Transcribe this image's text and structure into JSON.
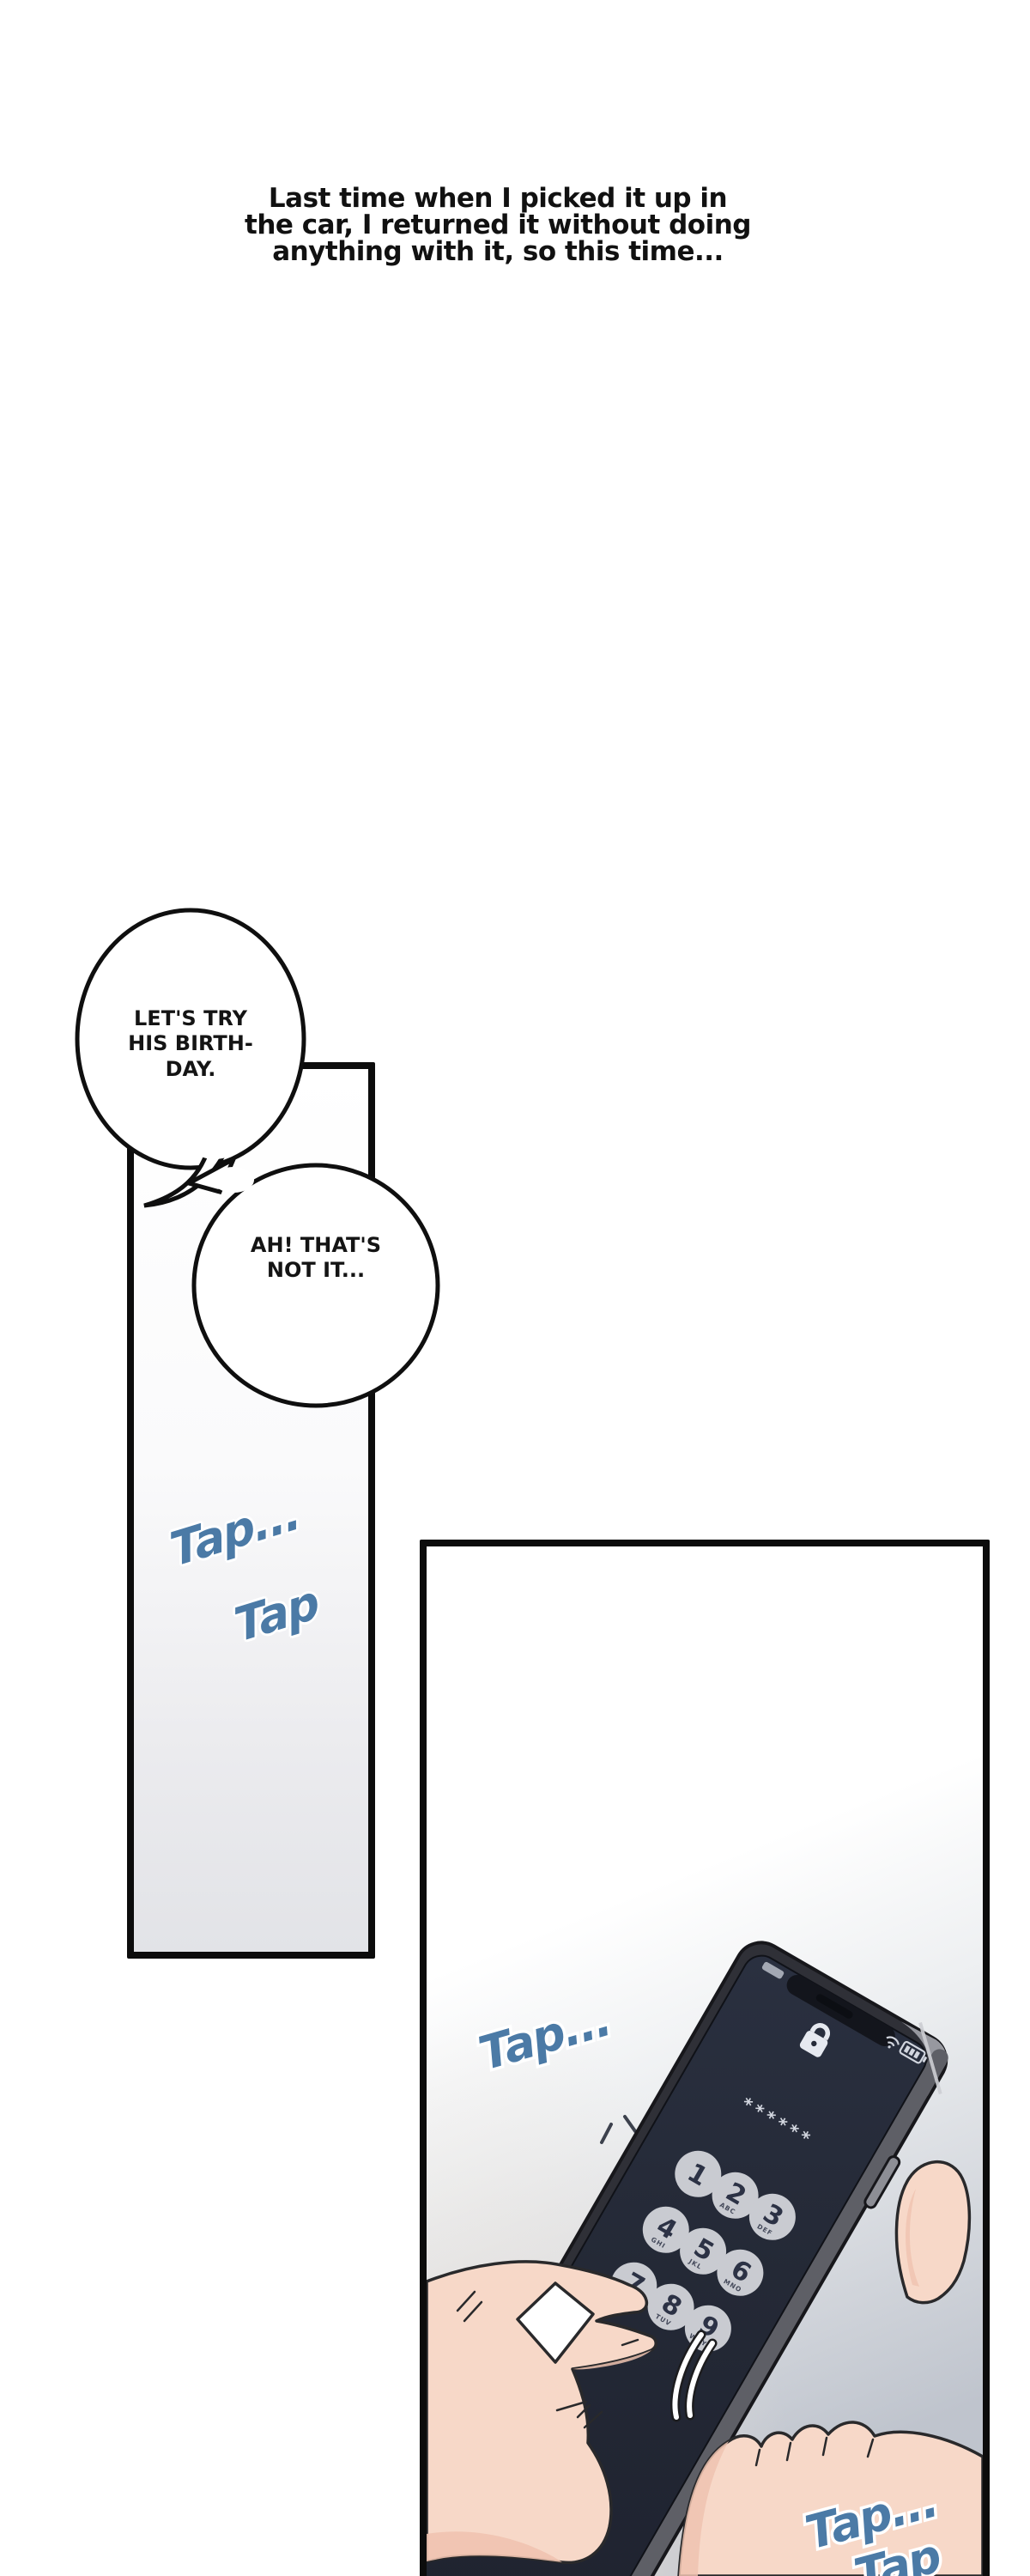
{
  "narration": {
    "lines": [
      "Last time when I picked it up in",
      "the car, I returned it without doing",
      "anything with it, so this time..."
    ]
  },
  "bubbles": {
    "bubble1": {
      "lines": [
        "LET'S TRY",
        "HIS BIRTH-",
        "DAY."
      ]
    },
    "bubble2": {
      "lines": [
        "AH! THAT'S",
        "NOT IT..."
      ]
    }
  },
  "sfx": {
    "color": "#4b7aa6",
    "panel1_tap_a": "Tap...",
    "panel1_tap_b": "Tap",
    "panel2_tap_top": "Tap...",
    "panel2_tap_bottom": "Tap...",
    "panel2_tap_partial": "Tap"
  },
  "phone": {
    "passcode_display": "******",
    "lock_icon": "lock-icon",
    "status_icons": [
      "wifi-icon",
      "battery-icon"
    ],
    "keypad": [
      {
        "digit": "1",
        "letters": ""
      },
      {
        "digit": "2",
        "letters": "ABC"
      },
      {
        "digit": "3",
        "letters": "DEF"
      },
      {
        "digit": "4",
        "letters": "GHI"
      },
      {
        "digit": "5",
        "letters": "JKL"
      },
      {
        "digit": "6",
        "letters": "MNO"
      },
      {
        "digit": "7",
        "letters": "PQRS"
      },
      {
        "digit": "8",
        "letters": "TUV"
      },
      {
        "digit": "9",
        "letters": "WXYZ"
      }
    ]
  },
  "colors": {
    "sfx_blue": "#4b7aa6",
    "panel_border": "#0c0c0c",
    "screen_dark": "#262b39",
    "key_fill": "#c9cbd1",
    "key_text": "#2c3245",
    "skin": "#f7d8c8",
    "skin_shadow": "#efc3b0"
  }
}
